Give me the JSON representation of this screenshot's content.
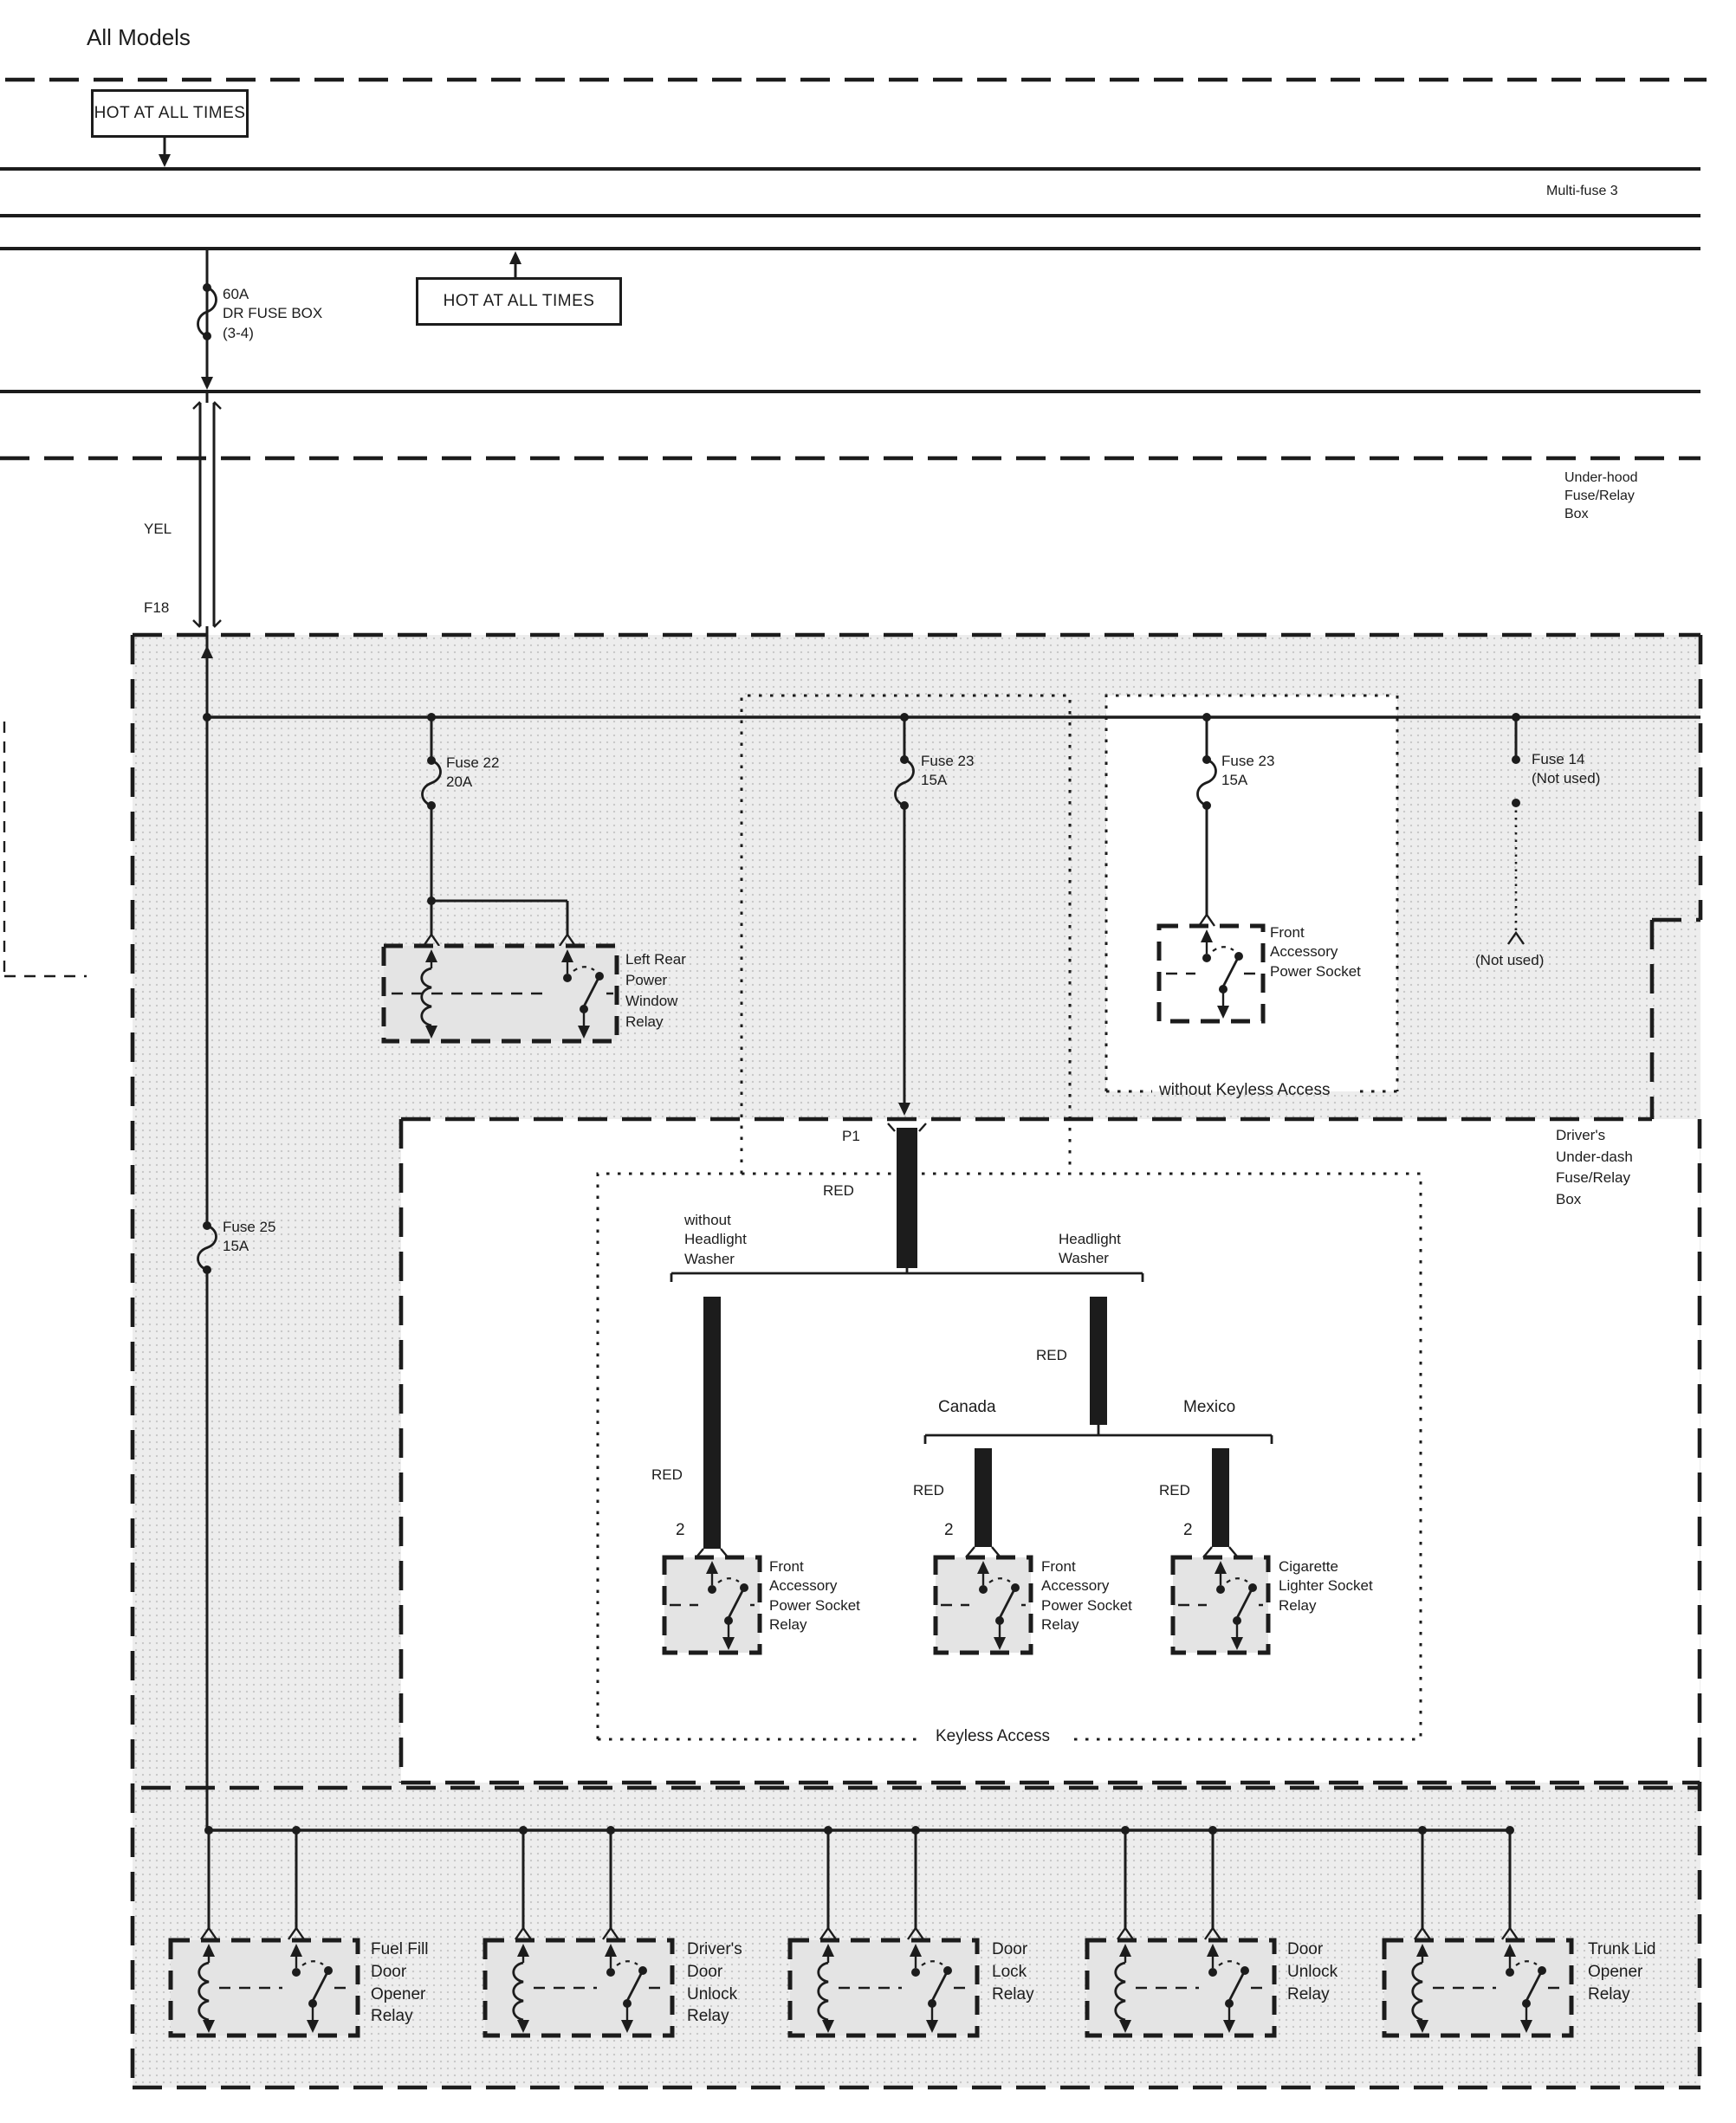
{
  "colors": {
    "ink": "#1c1c1c",
    "panel_gray": "#ededed",
    "wire_red_bar": "#1c1c1c"
  },
  "header": {
    "title": "All Models",
    "hot_at_all_times_1": "HOT AT ALL TIMES",
    "hot_at_all_times_2": "HOT AT ALL TIMES",
    "multi_fuse": "Multi-fuse 3",
    "main_fuse": [
      "60A",
      "DR FUSE BOX",
      "(3-4)"
    ]
  },
  "underhood": {
    "label": [
      "Under-hood",
      "Fuse/Relay",
      "Box"
    ],
    "wire_color": "YEL",
    "connector": "F18"
  },
  "fuses": {
    "fuse22": [
      "Fuse 22",
      "20A"
    ],
    "fuse23_mid": [
      "Fuse 23",
      "15A"
    ],
    "fuse23_right": [
      "Fuse 23",
      "15A"
    ],
    "fuse14": [
      "Fuse 14",
      "(Not used)"
    ],
    "fuse14_end": "(Not used)",
    "fuse25": [
      "Fuse 25",
      "15A"
    ]
  },
  "underdash": {
    "box_label": [
      "Driver's",
      "Under-dash",
      "Fuse/Relay",
      "Box"
    ],
    "without_keyless": "without Keyless Access",
    "keyless": "Keyless Access",
    "socket_label": [
      "Front",
      "Accessory",
      "Power Socket"
    ],
    "left_rear_relay": [
      "Left Rear",
      "Power",
      "Window",
      "Relay"
    ],
    "p1": "P1",
    "red": "RED",
    "pin2": "2",
    "branch_left": [
      "without",
      "Headlight",
      "Washer"
    ],
    "branch_right": [
      "Headlight",
      "Washer"
    ],
    "canada": "Canada",
    "mexico": "Mexico",
    "relay_a": [
      "Front",
      "Accessory",
      "Power Socket",
      "Relay"
    ],
    "relay_b": [
      "Front",
      "Accessory",
      "Power Socket",
      "Relay"
    ],
    "relay_c": [
      "Cigarette",
      "Lighter Socket",
      "Relay"
    ]
  },
  "bottom": {
    "relay1": [
      "Fuel Fill",
      "Door",
      "Opener",
      "Relay"
    ],
    "relay2": [
      "Driver's",
      "Door",
      "Unlock",
      "Relay"
    ],
    "relay3": [
      "Door",
      "Lock",
      "Relay"
    ],
    "relay4": [
      "Door",
      "Unlock",
      "Relay"
    ],
    "relay5": [
      "Trunk Lid",
      "Opener",
      "Relay"
    ]
  }
}
